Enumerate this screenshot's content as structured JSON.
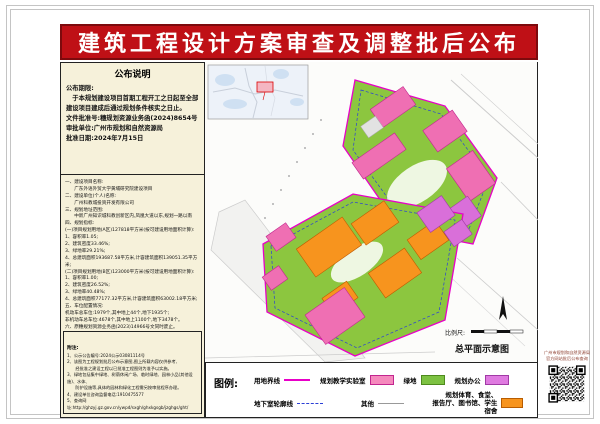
{
  "page": {
    "title": "建筑工程设计方案审查及调整批后公布"
  },
  "notice": {
    "title": "公布说明",
    "lines": [
      "公布期限:",
      "　于本规划建设项目首期工程开工之日起至全部",
      "建设项目建成后通过规划条件核实之日止。",
      "文件批准号:穗规划资源业务函(2024)8654号",
      "审批单位:广州市规划和自然资源局",
      "批准日期:2024年7月15日"
    ]
  },
  "details": {
    "lines": [
      "一、建设项目名称:",
      "　　广东外语外贸大学黄埔研究院建设项目",
      "二、建设单位(个人)名称:",
      "　　广州科教城投资开发有限公司",
      "三、规划地址范围:",
      "　　中新广州知识城科教创新区内,凤凰大道以东,规划一路以南",
      "四、规划指标:",
      "(一)项目规划用地(A区)127818平方米(按可建设用地面积计算):",
      "1、容积率1.05;",
      "2、建筑密度33.46%;",
      "3、绿地率29.21%;",
      "4、总建筑面积193687.58平方米,计容建筑面积139051.35平方米;",
      "(二)项目规划用地(B区)123000平方米(按可建设用地面积计算):",
      "1、容积率1.00;",
      "2、建筑密度26.52%;",
      "3、绿地率40.48%;",
      "4、总建筑面积77177.32平方米,计容建筑面积63002.18平方米;",
      "五、车位配置情况:",
      "机动车总车位:1979个,其中地上44个,地下1935个;",
      "非机动车总车位:4678个,其中地上1100个,地下3478个。",
      "六、原穗规划资源业务函(2023)14966号文同时废止。"
    ]
  },
  "footnotes": {
    "title": "附注:",
    "lines": [
      "1、公示公告编号:2024公示03081114号",
      "2、该图为工程规划批后公布示意图,图上所载内容仅供参考,",
      "　　经批准之建设工程以已批准工程图则为准予以实施。",
      "3、绿地包括集中绿地、树荫休闲广场、临时绿地、园林小品(其他设施)、水体、",
      "　　防护设施等,具体的园林和绿化工程需另按审批程序办理。",
      "4、建设单位咨询监督电话:1910475577",
      "5、查询网址:http://ghzyj.gz.gov.cn/ywpd/sxgh/ghxkgsgb/jzghgs/ght/"
    ]
  },
  "map": {
    "scale_label": "比例尺:",
    "caption": "总平面示意图"
  },
  "legend": {
    "title": "图例:",
    "items": [
      {
        "label": "用地界线",
        "type": "line",
        "color": "#e800c8"
      },
      {
        "label": "规划教学实验室",
        "type": "swatch",
        "color": "#f589bd"
      },
      {
        "label": "绿地",
        "type": "swatch",
        "color": "#7dc242"
      },
      {
        "label": "规划办公",
        "type": "swatch",
        "color": "#df7ae0"
      },
      {
        "label": "地下室轮廓线",
        "type": "dashed-line",
        "color": "#2b3fd6"
      },
      {
        "label": "其他",
        "type": "line",
        "color": "#999999"
      },
      {
        "label": "规划体育、食堂、\n报告厅、图书馆、学生宿舍",
        "type": "swatch",
        "color": "#f7941e"
      }
    ]
  },
  "qr": {
    "caption": "广州市规划和自然资源局\n官方网站批后公布查询"
  },
  "colors": {
    "banner_red": "#bf1016",
    "panel_cream": "#f6f1da",
    "site_green": "#8cc63f",
    "building_pink": "#ef6fb3",
    "building_violet": "#d96fd9",
    "building_orange": "#f7941e",
    "boundary_magenta": "#e800c8",
    "underground_blue": "#2b3fd6"
  }
}
